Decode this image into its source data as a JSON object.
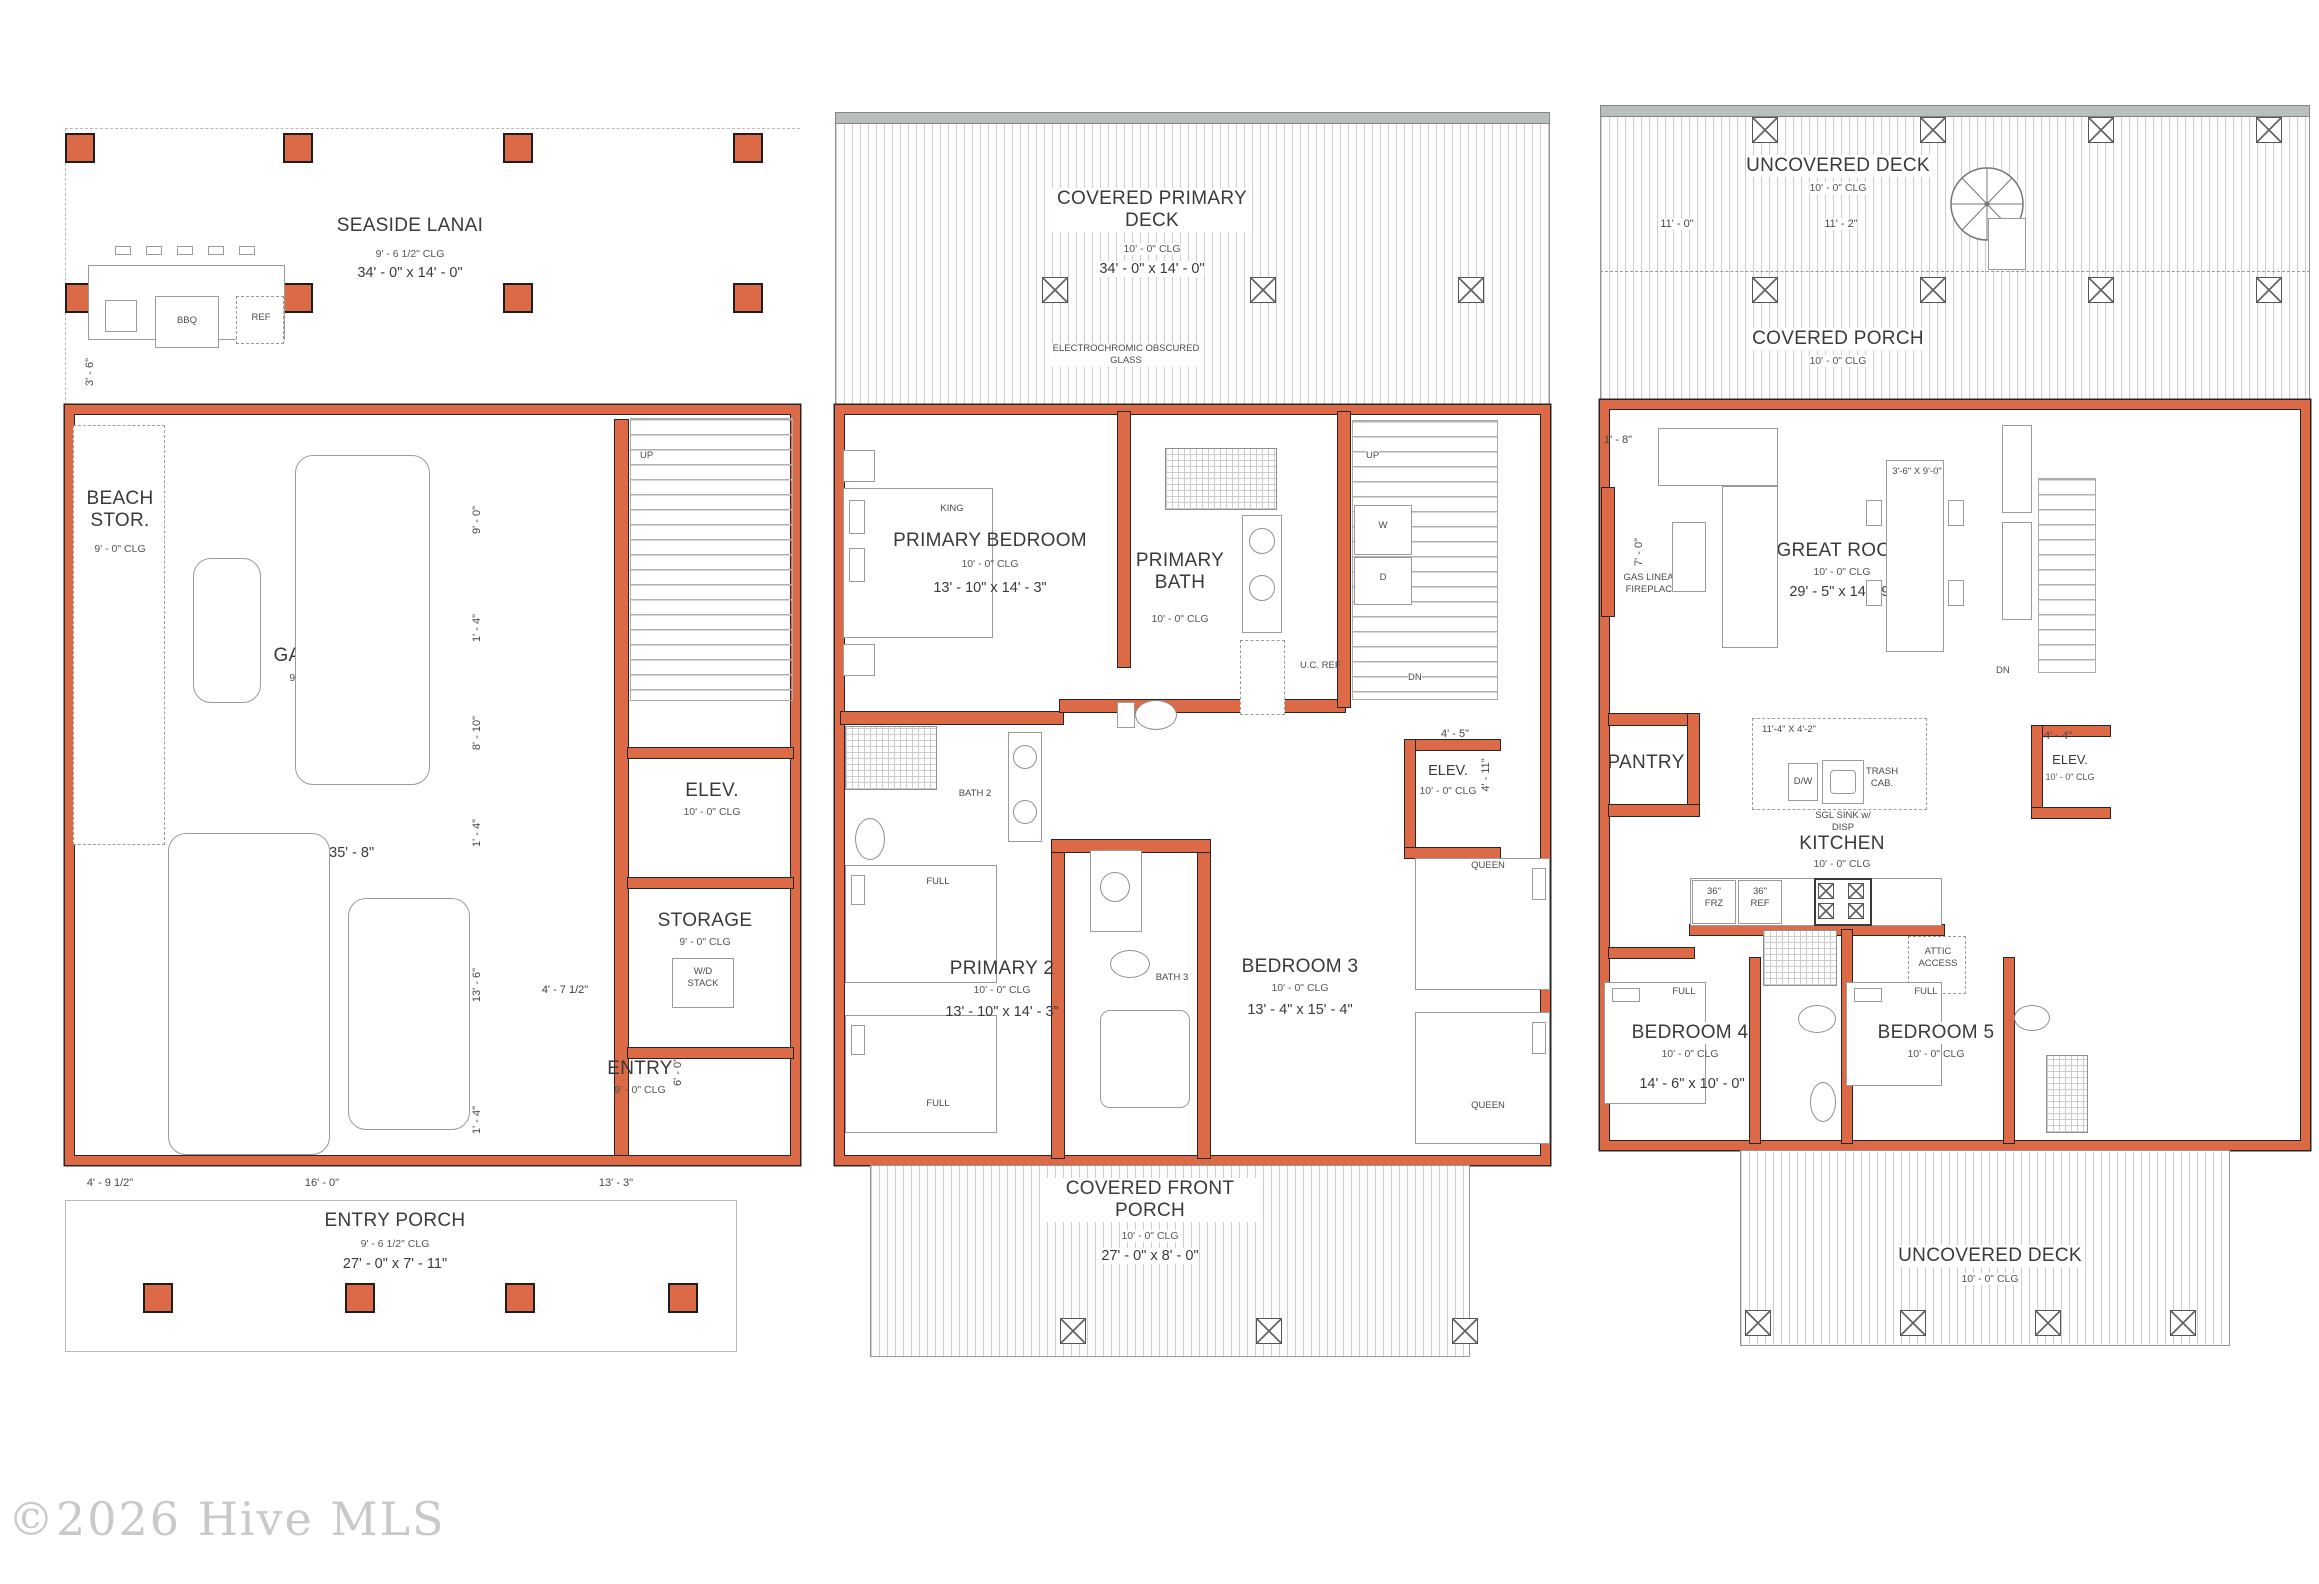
{
  "watermark": "©2026 Hive MLS",
  "plan1": {
    "lanai_name": "SEASIDE LANAI",
    "lanai_clg": "9' - 6 1/2\" CLG",
    "lanai_dims": "34' - 0\" x 14' - 0\"",
    "bbq": "BBQ",
    "ref": "REF",
    "dim_lanai": "3' - 6\"",
    "beach_name": "BEACH STOR.",
    "beach_clg": "9' - 0\" CLG",
    "garage_name": "GARAGE",
    "garage_clg": "9' - 0\" CLG",
    "garage_dims": "21' - 11\" x 35' - 8\"",
    "up": "UP",
    "elev_name": "ELEV.",
    "elev_clg": "10' - 0\" CLG",
    "storage_name": "STORAGE",
    "storage_clg": "9' - 0\" CLG",
    "wd_stack": "W/D STACK",
    "entry_name": "ENTRY",
    "entry_clg": "9' - 0\" CLG",
    "dim_chain": [
      "9' - 0\"",
      "1' - 4\"",
      "8' - 10\"",
      "1' - 4\"",
      "13' - 6\"",
      "1' - 4\""
    ],
    "dim_storage": "4' - 7 1/2\"",
    "dim_entry": "6' - 0\"",
    "dim_b1": "4' - 9 1/2\"",
    "dim_b2": "16' - 0\"",
    "dim_b3": "13' - 3\"",
    "porch_name": "ENTRY PORCH",
    "porch_clg": "9' - 6 1/2\" CLG",
    "porch_dims": "27' - 0\" x 7' - 11\""
  },
  "plan2": {
    "deck_name": "COVERED PRIMARY DECK",
    "deck_clg": "10' - 0\" CLG",
    "deck_dims": "34' - 0\" x 14' - 0\"",
    "glass": "ELECTROCHROMIC OBSCURED GLASS",
    "pbr_name": "PRIMARY BEDROOM",
    "pbr_clg": "10' - 0\" CLG",
    "pbr_dims": "13' - 10\" x 14' - 3\"",
    "king": "KING",
    "pbath_name": "PRIMARY BATH",
    "pbath_clg": "10' - 0\" CLG",
    "ucref": "U.C. REF",
    "bath2": "BATH 2",
    "up": "UP",
    "dn": "DN",
    "w": "W",
    "d": "D",
    "elev_name": "ELEV.",
    "elev_clg": "10' - 0\" CLG",
    "elev_d1": "4' - 5\"",
    "elev_d2": "4' - 11\"",
    "p2_name": "PRIMARY 2",
    "p2_clg": "10' - 0\" CLG",
    "p2_dims": "13' - 10\" x 14' - 3\"",
    "full": "FULL",
    "bath3": "BATH 3",
    "b3_name": "BEDROOM 3",
    "b3_clg": "10' - 0\" CLG",
    "b3_dims": "13' - 4\" x 15' - 4\"",
    "queen": "QUEEN",
    "porch_name": "COVERED FRONT PORCH",
    "porch_clg": "10' - 0\" CLG",
    "porch_dims": "27' - 0\" x 8' - 0\""
  },
  "plan3": {
    "deck_name": "UNCOVERED DECK",
    "deck_clg": "10' - 0\" CLG",
    "d1": "11' - 0\"",
    "d2": "11' - 2\"",
    "d3": "11' - 0\"",
    "cporch_name": "COVERED PORCH",
    "cporch_clg": "10' - 0\" CLG",
    "great_name": "GREAT ROOM",
    "great_clg": "10' - 0\" CLG",
    "great_dims": "29' - 5\" x 14' - 9\"",
    "fireplace": "GAS LINEAR FIREPLACE",
    "dim_fp": "7' - 0\"",
    "dim_corner": "1' - 8\"",
    "table_dims": "3'-6\" X 9'-0\"",
    "dn": "DN",
    "pantry": "PANTRY",
    "island_dims": "11'-4\" X 4'-2\"",
    "dw": "D/W",
    "sink": "SGL SINK w/ DISP",
    "trash": "TRASH CAB.",
    "kitchen_name": "KITCHEN",
    "kitchen_clg": "10' - 0\" CLG",
    "frz": "36\" FRZ",
    "refr": "36\" REF",
    "elev_name": "ELEV.",
    "elev_clg": "10' - 0\" CLG",
    "elev_d": "4' - 4\"",
    "attic": "ATTIC ACCESS",
    "b4_name": "BEDROOM 4",
    "b4_clg": "10' - 0\" CLG",
    "b4_dims": "14' - 6\" x 10' - 0\"",
    "full": "FULL",
    "b5_name": "BEDROOM 5",
    "b5_clg": "10' - 0\" CLG",
    "deck2_name": "UNCOVERED DECK",
    "deck2_clg": "10' - 0\" CLG"
  }
}
